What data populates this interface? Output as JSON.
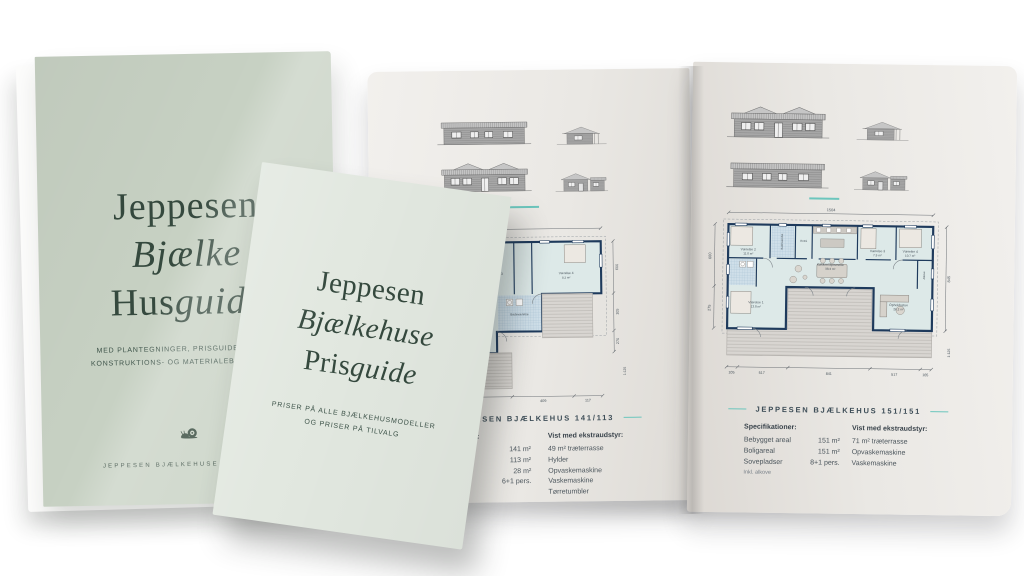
{
  "colors": {
    "accent_teal": "#6cc6bd",
    "husguide_cover_green": "#c7d1c3",
    "prisguide_cover_green": "#e2e8e0",
    "title_green": "#35493e",
    "plan_wall_navy": "#1e3a5c",
    "page_gray": "#eae8e4"
  },
  "husguide": {
    "title1": "Jeppesen",
    "title2": "Bjælke",
    "title3_roman": "Hus",
    "title3_italic": "guide",
    "subtitle1": "MED PLANTEGNINGER, PRISGUIDE, TILVALG,",
    "subtitle2": "KONSTRUKTIONS- OG MATERIALEBESKRIVELSE",
    "footer": "JEPPESEN BJÆLKEHUSE  ·  EST. 1992"
  },
  "prisguide": {
    "title1": "Jeppesen",
    "title2": "Bjælkehuse",
    "title3_roman": "Pris",
    "title3_italic": "guide",
    "subtitle1": "PRISER PÅ ALLE BJÆLKEHUSMODELLER",
    "subtitle2": "OG PRISER PÅ TILVALG"
  },
  "left_page": {
    "caption": "JEPPESEN BJÆLKEHUS 141/113",
    "specs_heading": "Specifikationer:",
    "specs": [
      {
        "label": "Bebygget areal",
        "value": "141 m²"
      },
      {
        "label": "Boligareal",
        "value": "113 m²"
      },
      {
        "label": "Træterrasse",
        "value": "28 m²"
      },
      {
        "label": "Sovepladser",
        "value": "6+1 pers."
      }
    ],
    "extras_heading": "Vist med ekstraudstyr:",
    "extras": [
      "49 m² træterrasse",
      "Hylder",
      "Opvaskemaskine",
      "Vaskemaskine",
      "Tørretumbler"
    ],
    "plan": {
      "rooms": {
        "kokken": "Køkken",
        "v3_name": "Værelse 3",
        "v3_area": "7.6 m²",
        "v4_name": "Værelse 4",
        "v4_area": "8.2 m²",
        "bad": "Badeværelse",
        "stue": "Stue",
        "redskab": "Redskabsrum"
      },
      "dims_right": [
        "600",
        "105",
        "270"
      ],
      "dims_bottom": [
        "500",
        "409",
        "117"
      ],
      "scale": "1:125"
    }
  },
  "right_page": {
    "caption": "JEPPESEN BJÆLKEHUS 151/151",
    "specs_heading": "Specifikationer:",
    "specs": [
      {
        "label": "Bebygget areal",
        "value": "151 m²"
      },
      {
        "label": "Boligareal",
        "value": "151 m²"
      },
      {
        "label": "Sovepladser",
        "value": "8+1 pers."
      }
    ],
    "specs_note": "Inkl. alkove",
    "extras_heading": "Vist med ekstraudstyr:",
    "extras": [
      "71 m² træterrasse",
      "Opvaskemaskine",
      "Vaskemaskine"
    ],
    "plan": {
      "rooms": {
        "v2_name": "Værelse 2",
        "v2_area": "11.0 m²",
        "v3_name": "Værelse 3",
        "v3_area": "7.9 m²",
        "v4_name": "Værelse 4",
        "v4_area": "10.7 m²",
        "v1_name": "Værelse 1",
        "v1_area": "13.8 m²",
        "kitchen_name": "Køkken/Spisestue",
        "kitchen_area": "38.3 m²",
        "ophold_name": "Opholdsstue",
        "ophold_area": "26.2 m²",
        "bad": "Badeværelse",
        "entre": "Entré",
        "alkove": "Alkove"
      },
      "dims_top": "1504",
      "dims_left": [
        "600",
        "275"
      ],
      "dims_right": [
        "845"
      ],
      "dims_bottom": [
        "105",
        "517",
        "841",
        "517",
        "105"
      ],
      "scale": "1:125"
    }
  }
}
